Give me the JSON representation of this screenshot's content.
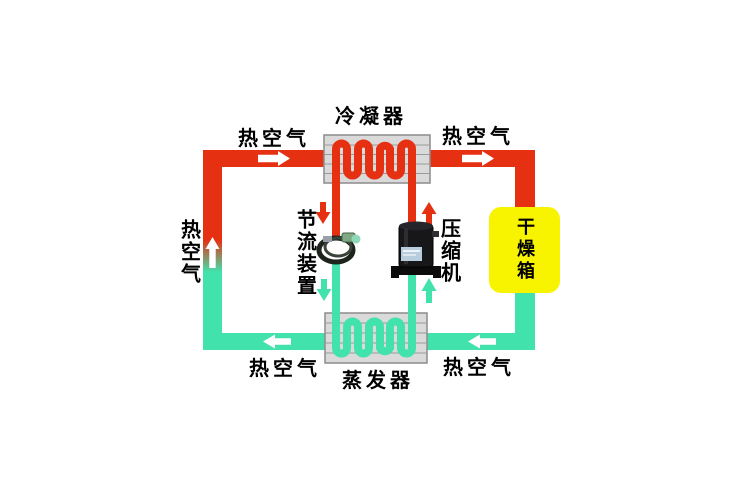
{
  "diagram": {
    "type": "heat-pump drying system schematic",
    "components": {
      "condenser": {
        "label": "冷凝器"
      },
      "evaporator": {
        "label": "蒸发器"
      },
      "compressor": {
        "label": "压缩机"
      },
      "throttle_device": {
        "label": "节流装置"
      },
      "drying_box": {
        "label": "干燥箱"
      }
    },
    "air_labels": {
      "top_left": "热空气",
      "top_right": "热空气",
      "left": "热空气",
      "bottom_left": "热空气",
      "bottom_right": "热空气"
    },
    "colors": {
      "hot_pipe": "#e63012",
      "cold_pipe": "#42e2ad",
      "drying_box_fill": "#f8f400",
      "exchanger_fill": "#dadada",
      "exchanger_border": "#8c8c8c",
      "fin_line": "#9a9a9a",
      "arrow_on_pipe": "#ffffff",
      "text": "#000000",
      "background": "#ffffff"
    }
  }
}
